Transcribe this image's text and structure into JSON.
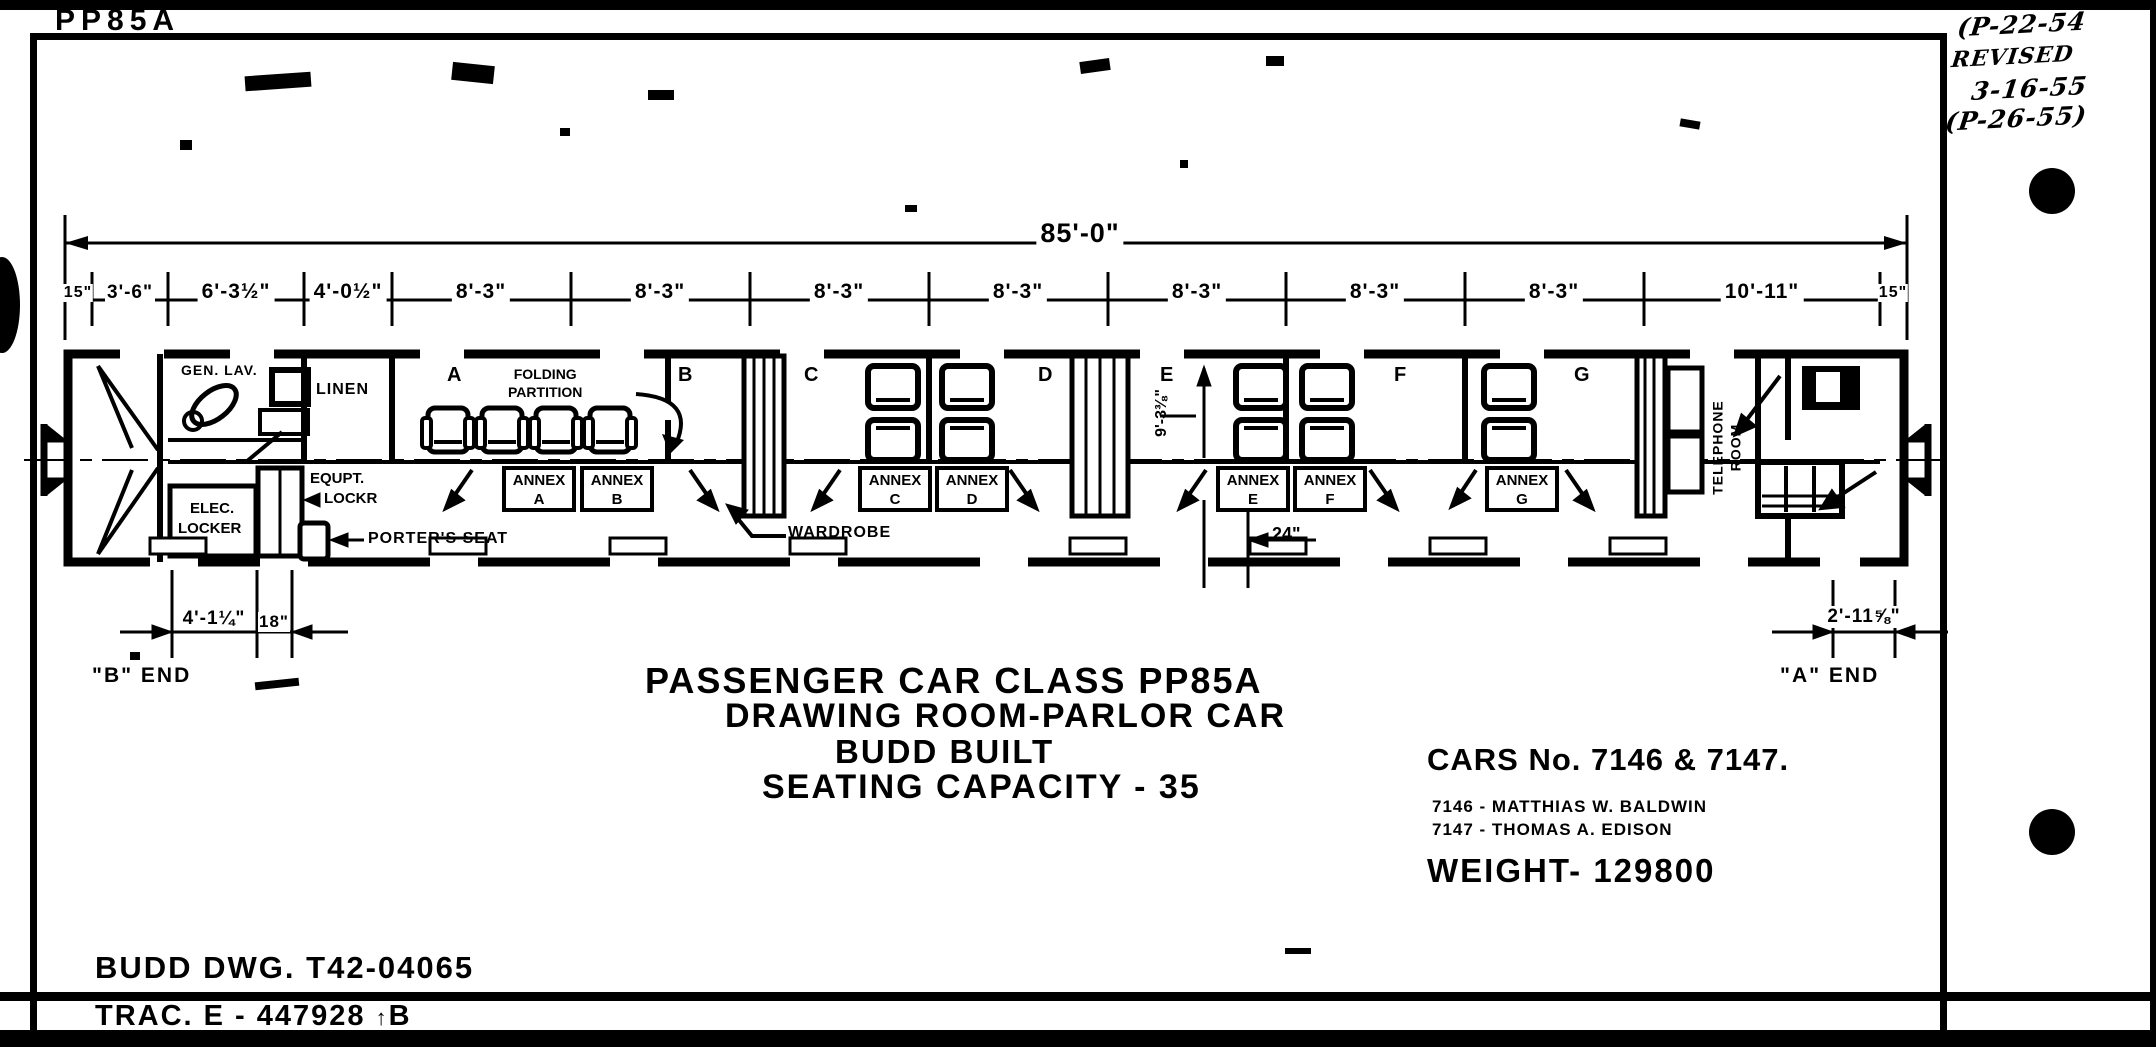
{
  "sheet": {
    "class_label": "PP85A",
    "revision": [
      "(P-22-54",
      "REVISED",
      "3-16-55",
      "(P-26-55)"
    ]
  },
  "dims": {
    "overall": "85'-0\"",
    "segments": [
      "15\"",
      "3'-6\"",
      "6'-3½\"",
      "4'-0½\"",
      "8'-3\"",
      "8'-3\"",
      "8'-3\"",
      "8'-3\"",
      "8'-3\"",
      "8'-3\"",
      "8'-3\"",
      "10'-11\"",
      "15\""
    ],
    "room_depth": "9'-3⅜\"",
    "aisle": "24\"",
    "b_end": [
      "4'-1¼\"",
      "18\""
    ],
    "a_end": "2'-11⅝\""
  },
  "plan": {
    "room_letters": [
      "A",
      "B",
      "C",
      "D",
      "E",
      "F",
      "G"
    ],
    "annexes": [
      {
        "line1": "ANNEX",
        "line2": "A"
      },
      {
        "line1": "ANNEX",
        "line2": "B"
      },
      {
        "line1": "ANNEX",
        "line2": "C"
      },
      {
        "line1": "ANNEX",
        "line2": "D"
      },
      {
        "line1": "ANNEX",
        "line2": "E"
      },
      {
        "line1": "ANNEX",
        "line2": "F"
      },
      {
        "line1": "ANNEX",
        "line2": "G"
      }
    ],
    "labels": {
      "gen_lav": "GEN. LAV.",
      "linen": "LINEN",
      "folding1": "FOLDING",
      "folding2": "PARTITION",
      "equpt1": "EQUPT.",
      "equpt2": "LOCKR",
      "elec1": "ELEC.",
      "elec2": "LOCKER",
      "porters": "PORTER'S SEAT",
      "wardrobe": "WARDROBE",
      "tel1": "TELEPHONE",
      "tel2": "ROOM",
      "b_end": "\"B\" END",
      "a_end": "\"A\" END"
    }
  },
  "title_block": {
    "line1": "PASSENGER CAR CLASS PP85A",
    "line2": "DRAWING ROOM-PARLOR CAR",
    "line3": "BUDD BUILT",
    "line4": "SEATING CAPACITY - 35"
  },
  "car_info": {
    "cars_no": "CARS No. 7146 & 7147.",
    "names": [
      "7146 -  MATTHIAS W. BALDWIN",
      "7147 -  THOMAS A. EDISON"
    ],
    "weight": "WEIGHT-  129800"
  },
  "footer": {
    "budd_dwg": "BUDD DWG.  T42-04065",
    "trac": "TRAC.  E - 447928",
    "trac_mark": "↑",
    "trac_suffix": "B"
  }
}
